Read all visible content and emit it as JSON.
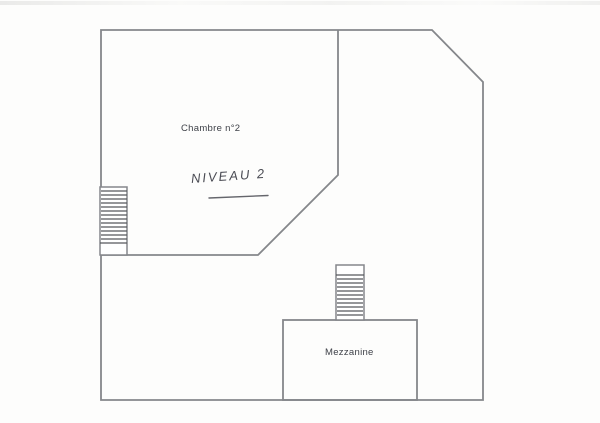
{
  "plan": {
    "rooms": [
      {
        "label": "Chambre n°2"
      },
      {
        "label": "Mezzanine"
      }
    ],
    "annotation": {
      "text": "NIVEAU 2"
    },
    "colors": {
      "background": "#fdfdfc",
      "wall": "#85878b",
      "hatch": "#56585c",
      "label_text": "#3e4148",
      "handwriting": "#4b4c54"
    }
  }
}
